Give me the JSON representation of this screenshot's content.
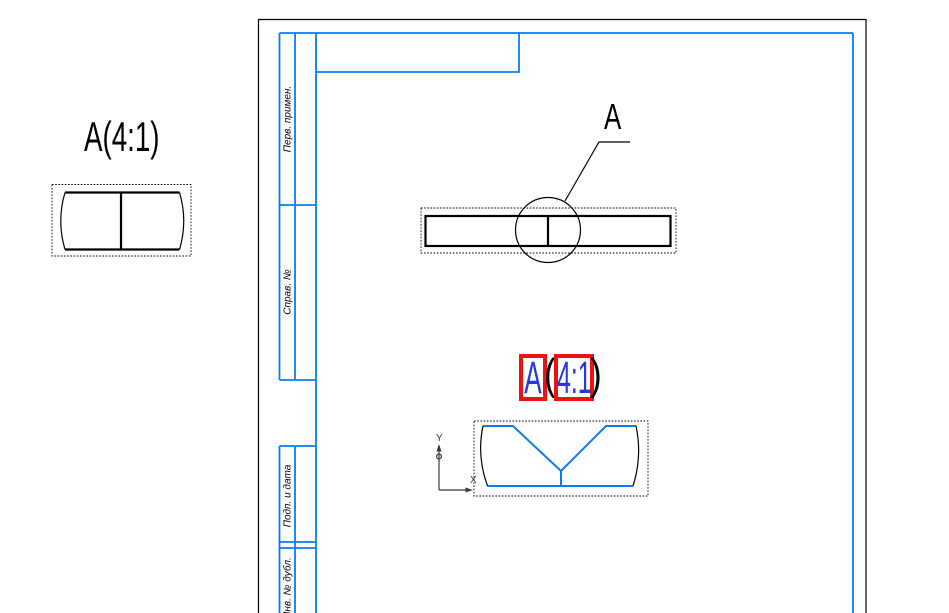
{
  "colors": {
    "frame_blue": "#0b7cf0",
    "selection_red": "#ee1111",
    "field_blue": "#2636e0",
    "line_black": "#000000",
    "axis_gray": "#3a3a3a",
    "background_white": "#ffffff"
  },
  "external_detail_view": {
    "label": "A(4:1)"
  },
  "sheet": {
    "title_block_columns": [
      {
        "label": "Перв. примен."
      },
      {
        "label": "Справ. №"
      },
      {
        "label": "Подп. и дата"
      },
      {
        "label": "Инв. № дубл."
      }
    ],
    "callout": {
      "label": "A"
    },
    "detail_label": {
      "letter": "A",
      "paren_open": "(",
      "scale": "4:1",
      "paren_close": ")"
    },
    "axes": {
      "x_label": "X",
      "y_label": "Y"
    }
  }
}
